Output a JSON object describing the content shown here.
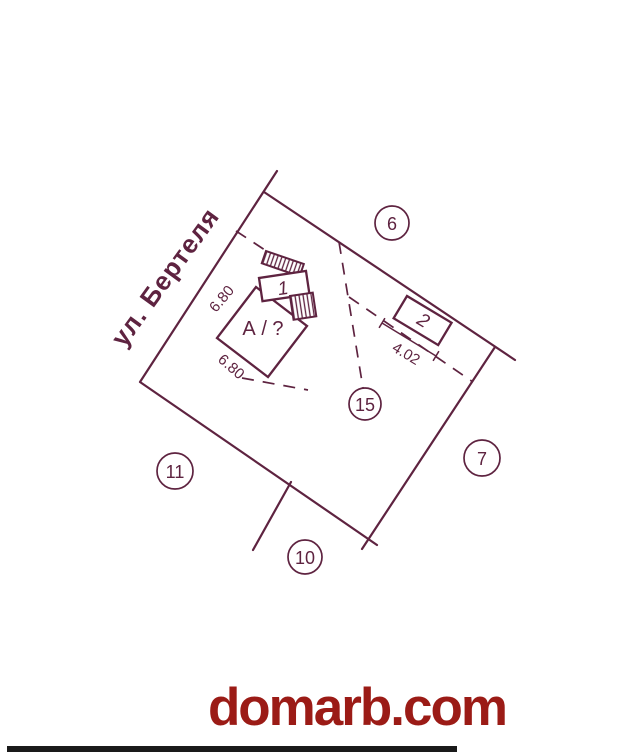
{
  "street_label": "ул. Бертеля",
  "building": {
    "label": "А / ?"
  },
  "structures": {
    "annex1_label": "1",
    "annex2_label": "2"
  },
  "dimensions": {
    "side_upper": "6.80",
    "side_lower": "6.80",
    "front": "4.02"
  },
  "markers": [
    {
      "label": "6"
    },
    {
      "label": "7"
    },
    {
      "label": "10"
    },
    {
      "label": "11"
    },
    {
      "label": "15"
    }
  ],
  "watermark": {
    "text": "domarb.com"
  },
  "colors": {
    "ink": "#5E2340",
    "watermark_red": "#9B1B16",
    "scan_bar": "#1A1A1A",
    "background": "#FFFFFF"
  }
}
